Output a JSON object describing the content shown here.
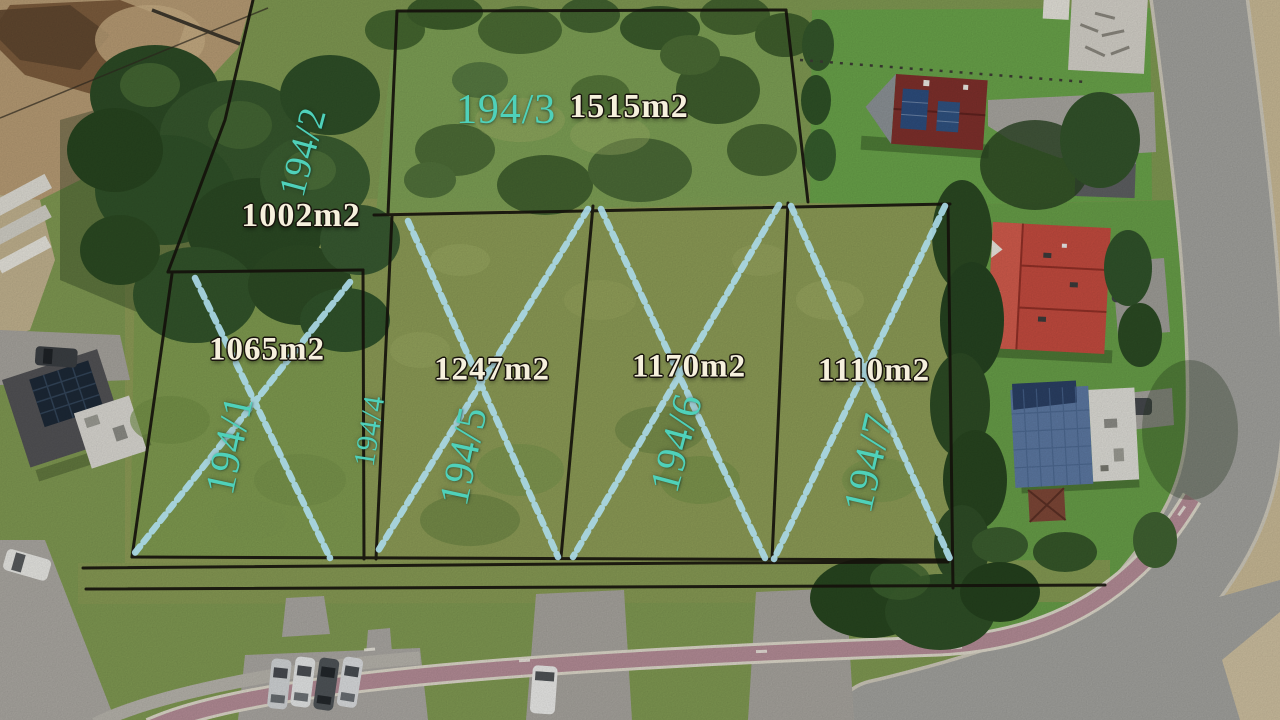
{
  "annotation_colors": {
    "plot_number_text": "#4fd1ba",
    "area_label_text": "#f6f0dd",
    "boundary_line": "#14110b",
    "sold_cross": "#a9d8e6"
  },
  "plots": [
    {
      "number": "194/1",
      "area_label": "1065m2",
      "crossed_out": true
    },
    {
      "number": "194/2",
      "area_label": "1002m2",
      "crossed_out": false
    },
    {
      "number": "194/3",
      "area_label": "1515m2",
      "crossed_out": false
    },
    {
      "number": "194/4",
      "crossed_out": false
    },
    {
      "number": "194/5",
      "area_label": "1247m2",
      "crossed_out": true
    },
    {
      "number": "194/6",
      "area_label": "1170m2",
      "crossed_out": true
    },
    {
      "number": "194/7",
      "area_label": "1110m2",
      "crossed_out": true
    }
  ]
}
